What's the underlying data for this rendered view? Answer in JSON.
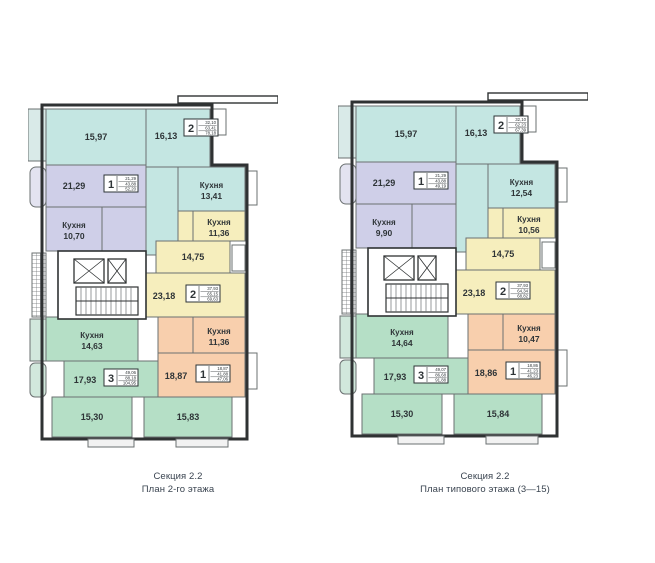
{
  "labels": {
    "kitchen": "Кухня"
  },
  "colors": {
    "cyan": "#c4e6e2",
    "lavender": "#cfcfe8",
    "yellow": "#f6eebd",
    "green": "#b5dfc6",
    "orange": "#f8cfad",
    "wall": "#2f3233",
    "wall_light": "#6b7071",
    "label": "#2e3437",
    "caption": "#3a4450",
    "balcony_cyan": "#d9eae8",
    "balcony_lav": "#e3e3f0",
    "balcony_green": "#d1e8dc",
    "porch": "#f2f2f2"
  },
  "geometry": {
    "outline": "14,2 184,2 184,62 219,62 219,336 14,336",
    "strip": {
      "x": 150,
      "y": -7,
      "w": 100,
      "h": 7
    },
    "rooms": [
      {
        "key": "liv_a1",
        "x": 18,
        "y": 6,
        "w": 100,
        "h": 56,
        "c": "cyan"
      },
      {
        "key": "liv_a2",
        "x": 118,
        "y": 6,
        "w": 64,
        "h": 58,
        "c": "cyan",
        "lx": 138,
        "ly": 36
      },
      {
        "key": "hall_a",
        "x": 118,
        "y": 64,
        "w": 32,
        "h": 88,
        "c": "cyan"
      },
      {
        "key": "kit_a",
        "x": 150,
        "y": 64,
        "w": 67,
        "h": 44,
        "c": "cyan",
        "kitchen": true
      },
      {
        "key": "liv_b",
        "x": 18,
        "y": 62,
        "w": 100,
        "h": 42,
        "c": "lavender",
        "lx": 46,
        "ly": 86
      },
      {
        "key": "kit_b",
        "x": 18,
        "y": 104,
        "w": 56,
        "h": 44,
        "c": "lavender",
        "kitchen": true
      },
      {
        "key": "hall_b",
        "x": 74,
        "y": 104,
        "w": 44,
        "h": 44,
        "c": "lavender"
      },
      {
        "key": "kit_c",
        "x": 165,
        "y": 108,
        "w": 52,
        "h": 30,
        "c": "yellow",
        "kitchen": true
      },
      {
        "key": "hall_c",
        "x": 150,
        "y": 108,
        "w": 15,
        "h": 62,
        "c": "yellow"
      },
      {
        "key": "liv_c1",
        "x": 128,
        "y": 138,
        "w": 74,
        "h": 32,
        "c": "yellow"
      },
      {
        "key": "liv_c2",
        "x": 112,
        "y": 170,
        "w": 105,
        "h": 44,
        "c": "yellow",
        "lx": 136,
        "ly": 196
      },
      {
        "key": "kit_d",
        "x": 18,
        "y": 214,
        "w": 92,
        "h": 44,
        "c": "green",
        "kitchen": true
      },
      {
        "key": "liv_d1",
        "x": 36,
        "y": 258,
        "w": 94,
        "h": 36,
        "c": "green",
        "lx": 57,
        "ly": 280
      },
      {
        "key": "liv_d2",
        "x": 24,
        "y": 294,
        "w": 80,
        "h": 40,
        "c": "green"
      },
      {
        "key": "liv_d3",
        "x": 116,
        "y": 294,
        "w": 88,
        "h": 40,
        "c": "green"
      },
      {
        "key": "kit_e",
        "x": 165,
        "y": 214,
        "w": 52,
        "h": 36,
        "c": "orange",
        "kitchen": true
      },
      {
        "key": "hall_e",
        "x": 130,
        "y": 214,
        "w": 35,
        "h": 36,
        "c": "orange"
      },
      {
        "key": "liv_e",
        "x": 130,
        "y": 250,
        "w": 87,
        "h": 44,
        "c": "orange",
        "lx": 148,
        "ly": 276
      }
    ],
    "balconies": [
      {
        "name": "balcony-top-left",
        "x": 0,
        "y": 6,
        "w": 18,
        "h": 52,
        "fill": "balcony_cyan"
      },
      {
        "name": "balcony-left-lavender",
        "x": 2,
        "y": 64,
        "w": 16,
        "h": 40,
        "fill": "balcony_lav",
        "r": 6
      },
      {
        "name": "balcony-left-hatch",
        "x": 4,
        "y": 150,
        "w": 14,
        "h": 64,
        "fill": "grid"
      },
      {
        "name": "balcony-left-green1",
        "x": 2,
        "y": 216,
        "w": 16,
        "h": 42,
        "fill": "balcony_green"
      },
      {
        "name": "balcony-left-green2",
        "x": 2,
        "y": 260,
        "w": 16,
        "h": 34,
        "fill": "balcony_green",
        "r": 5
      },
      {
        "name": "balcony-top-right",
        "x": 184,
        "y": 6,
        "w": 14,
        "h": 26,
        "fill": "white"
      },
      {
        "name": "balcony-right-cyan",
        "x": 219,
        "y": 68,
        "w": 10,
        "h": 34,
        "fill": "white"
      },
      {
        "name": "balcony-right-yellow",
        "x": 204,
        "y": 142,
        "w": 13,
        "h": 26,
        "fill": "white"
      },
      {
        "name": "balcony-right-orange",
        "x": 219,
        "y": 250,
        "w": 10,
        "h": 36,
        "fill": "white"
      }
    ],
    "porches": [
      {
        "x": 60,
        "y": 336,
        "w": 46,
        "h": 8
      },
      {
        "x": 148,
        "y": 336,
        "w": 52,
        "h": 8
      }
    ],
    "core": {
      "outer": {
        "x": 30,
        "y": 148,
        "w": 88,
        "h": 68
      },
      "elevators": [
        {
          "x": 46,
          "y": 156,
          "w": 30,
          "h": 24
        },
        {
          "x": 80,
          "y": 156,
          "w": 18,
          "h": 24
        }
      ],
      "stairs": {
        "x": 48,
        "y": 184,
        "w": 62,
        "h": 28
      }
    },
    "badge_pos": {
      "top2": [
        156,
        16
      ],
      "lav1": [
        76,
        72
      ],
      "yel2": [
        158,
        182
      ],
      "grn3": [
        76,
        266
      ],
      "org1": [
        168,
        262
      ]
    }
  },
  "plans": [
    {
      "caption1": "Секция 2.2",
      "caption2": "План 2-го этажа",
      "room_labels": {
        "liv_a1": "15,97",
        "liv_a2": "16,13",
        "kit_a": "13,41",
        "liv_b": "21,29",
        "kit_b": "10,70",
        "kit_c": "11,36",
        "liv_c1": "14,75",
        "liv_c2": "23,18",
        "kit_d": "14,63",
        "liv_d1": "17,93",
        "liv_d2": "15,30",
        "liv_d3": "15,83",
        "kit_e": "11,36",
        "liv_e": "18,87"
      },
      "badges": {
        "top2": {
          "num": "2",
          "lines": [
            "32,10",
            "63,41",
            "78,18"
          ]
        },
        "lav1": {
          "num": "1",
          "lines": [
            "21,29",
            "43,88",
            "52,20"
          ]
        },
        "yel2": {
          "num": "2",
          "lines": [
            "37,93",
            "65,15",
            "69,63"
          ]
        },
        "grn3": {
          "num": "3",
          "lines": [
            "49,06",
            "88,18",
            "104,95"
          ]
        },
        "org1": {
          "num": "1",
          "lines": [
            "18,87",
            "41,88",
            "47,06"
          ]
        }
      }
    },
    {
      "caption1": "Секция 2.2",
      "caption2": "План типового этажа (3—15)",
      "room_labels": {
        "liv_a1": "15,97",
        "liv_a2": "16,13",
        "kit_a": "12,54",
        "liv_b": "21,29",
        "kit_b": "9,90",
        "kit_c": "10,56",
        "liv_c1": "14,75",
        "liv_c2": "23,18",
        "kit_d": "14,64",
        "liv_d1": "17,93",
        "liv_d2": "15,30",
        "liv_d3": "15,84",
        "kit_e": "10,47",
        "liv_e": "18,86"
      },
      "badges": {
        "top2": {
          "num": "2",
          "lines": [
            "32,10",
            "62,23",
            "67,39"
          ]
        },
        "lav1": {
          "num": "1",
          "lines": [
            "21,29",
            "43,88",
            "49,19"
          ]
        },
        "yel2": {
          "num": "2",
          "lines": [
            "37,93",
            "64,34",
            "68,82"
          ]
        },
        "grn3": {
          "num": "3",
          "lines": [
            "49,07",
            "86,68",
            "91,88"
          ]
        },
        "org1": {
          "num": "1",
          "lines": [
            "18,86",
            "41,23",
            "46,23"
          ]
        }
      }
    }
  ]
}
